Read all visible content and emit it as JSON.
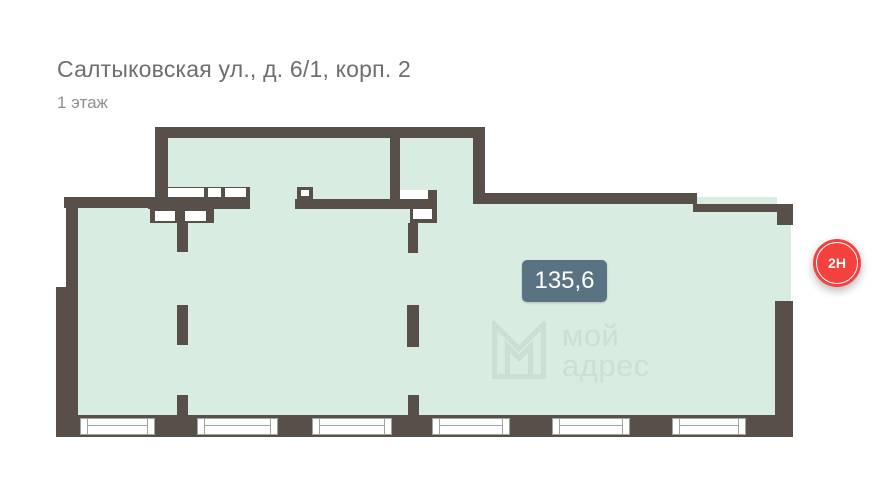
{
  "header": {
    "title": "Салтыковская ул., д. 6/1, корп. 2",
    "subtitle": "1 этаж"
  },
  "plan": {
    "area_label": "135,6",
    "unit_badge": "2Н"
  },
  "watermark": {
    "line1": "мой",
    "line2": "адрес",
    "logo_icon": "moi-adres-logo-icon"
  },
  "colors": {
    "wall": "#585048",
    "floor": "#d9ece2",
    "area_badge_bg": "#5a7383",
    "unit_badge_bg": "#f4413d",
    "watermark_text": "#cbdfd4",
    "title_text": "#6e6e6e",
    "subtitle_text": "#8f8f8f"
  }
}
